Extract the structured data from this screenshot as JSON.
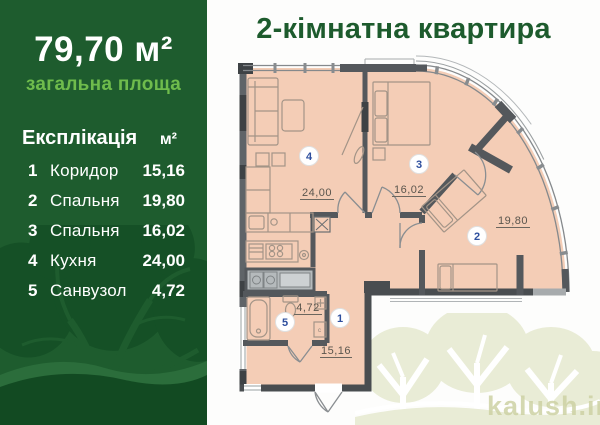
{
  "sidebar": {
    "total_area": "79,70 м²",
    "total_area_label": "загальна площа",
    "explication": {
      "title": "Експлікація",
      "unit": "м²"
    },
    "rows": [
      {
        "num": "1",
        "name": "Коридор",
        "area": "15,16"
      },
      {
        "num": "2",
        "name": "Спальня",
        "area": "19,80"
      },
      {
        "num": "3",
        "name": "Спальня",
        "area": "16,02"
      },
      {
        "num": "4",
        "name": "Кухня",
        "area": "24,00"
      },
      {
        "num": "5",
        "name": "Санвузол",
        "area": "4,72"
      }
    ],
    "colors": {
      "background": "#1e5c2e",
      "accent_green": "#6fbc4c",
      "tree_silhouette": "#155026"
    }
  },
  "plan": {
    "title": "2-кімнатна квартира",
    "rooms": [
      {
        "number": "1",
        "area_label": "15,16"
      },
      {
        "number": "2",
        "area_label": "19,80"
      },
      {
        "number": "3",
        "area_label": "16,02"
      },
      {
        "number": "4",
        "area_label": "24,00"
      },
      {
        "number": "5",
        "area_label": "4,72"
      }
    ],
    "colors": {
      "room_fill": "#f4cdb6",
      "wall": "#54585c",
      "badge_number": "#2e4f9e",
      "shaft": "#b5babc"
    }
  },
  "watermark": {
    "text": "kalush.inf",
    "tree_color": "#e9ecd6"
  }
}
